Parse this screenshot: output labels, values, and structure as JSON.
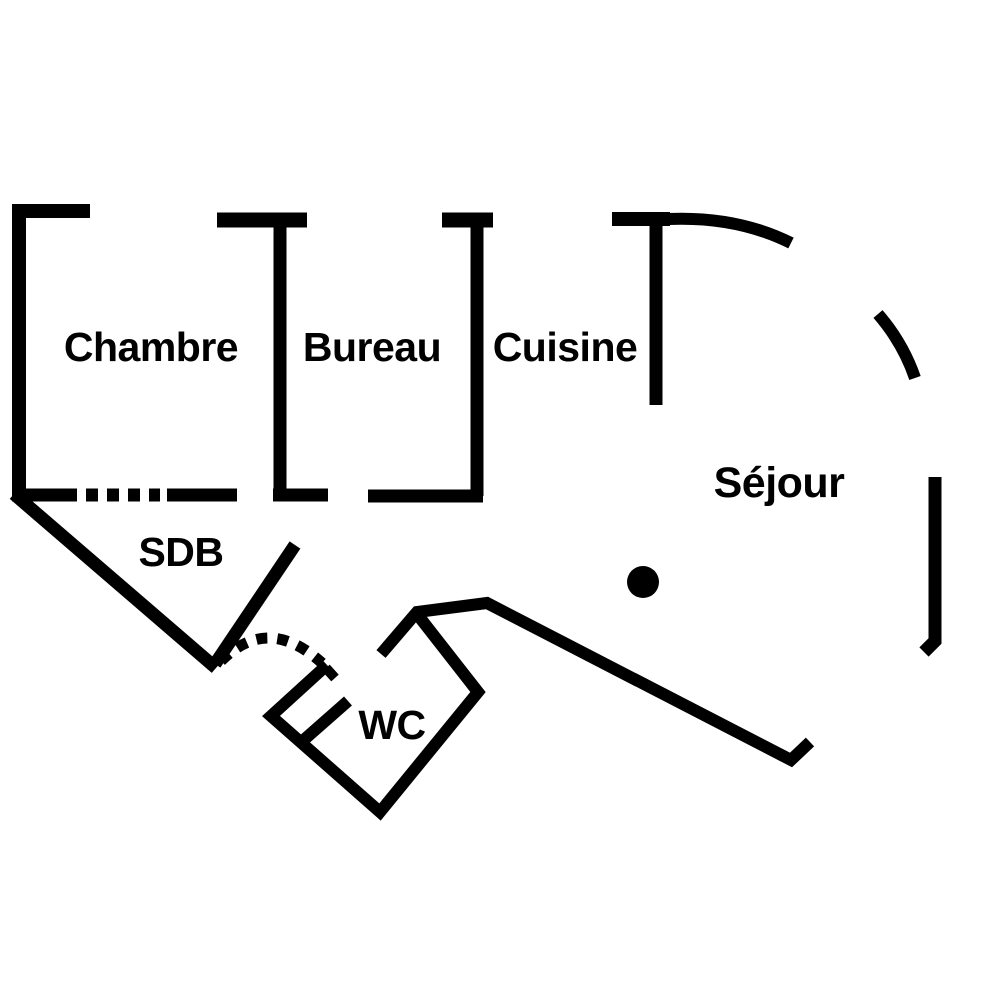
{
  "title": "Apartment floor plan",
  "colors": {
    "background": "#ffffff",
    "ink": "#000000"
  },
  "rooms": [
    {
      "id": "chambre",
      "label": "Chambre"
    },
    {
      "id": "bureau",
      "label": "Bureau"
    },
    {
      "id": "cuisine",
      "label": "Cuisine"
    },
    {
      "id": "sejour",
      "label": "Séjour"
    },
    {
      "id": "sdb",
      "label": "SDB"
    },
    {
      "id": "wc",
      "label": "WC"
    }
  ],
  "geometry": {
    "solid_walls": [
      {
        "name": "chambre-left-and-top-wall",
        "d": "M 90 211 L 19 211 L 19 498",
        "w": 14
      },
      {
        "name": "chambre-bottom-wall-left",
        "d": "M 12 495 L 77 495",
        "w": 13
      },
      {
        "name": "chambre-bottom-wall-right",
        "d": "M 167 495 L 237 495",
        "w": 13
      },
      {
        "name": "sdb-diagonal-wall",
        "d": "M 14 494 L 216 668",
        "w": 13
      },
      {
        "name": "bureau-divider-top-cap",
        "d": "M 217 220 L 307 220",
        "w": 15
      },
      {
        "name": "bureau-divider-stem",
        "d": "M 280 222 L 280 495",
        "w": 13
      },
      {
        "name": "bureau-divider-bottom-foot",
        "d": "M 273 495 L 328 495",
        "w": 13
      },
      {
        "name": "cuisine-divider-top-cap",
        "d": "M 442 220 L 493 220",
        "w": 15
      },
      {
        "name": "cuisine-divider-stem",
        "d": "M 477 222 L 477 496",
        "w": 13
      },
      {
        "name": "cuisine-divider-bottom-foot",
        "d": "M 368 496 L 483 496",
        "w": 13
      },
      {
        "name": "sejour-divider-top-cap",
        "d": "M 612 219 L 670 219",
        "w": 14
      },
      {
        "name": "sejour-divider-stem",
        "d": "M 656 221 L 656 405",
        "w": 13
      },
      {
        "name": "sejour-curved-wall-upper",
        "d": "M 668 219 Q 737 216 791 243",
        "w": 12
      },
      {
        "name": "sejour-curved-wall-middle",
        "d": "M 878 314 Q 903 343 915 378",
        "w": 12
      },
      {
        "name": "sejour-right-wall",
        "d": "M 935 477 L 935 641 L 924 652",
        "w": 13
      },
      {
        "name": "sejour-south-wall",
        "d": "M 381 654 L 417 612 L 487 603 L 791 760 L 810 742",
        "w": 12
      },
      {
        "name": "wc-walls",
        "d": "M 417 614 L 478 692 L 380 812 L 271 716 L 327 665",
        "w": 12
      },
      {
        "name": "wc-door-jamb-tick",
        "d": "M 326 668 L 335 678",
        "w": 10
      },
      {
        "name": "wc-door-leaf",
        "d": "M 348 701 L 298 745",
        "w": 12
      },
      {
        "name": "corridor-diagonal-wall",
        "d": "M 295 545 L 215 664",
        "w": 13
      }
    ],
    "dashed_walls": [
      {
        "name": "chambre-bottom-wall-dashed-opening",
        "d": "M 86 495 L 160 495",
        "w": 13,
        "dash": "12 9"
      },
      {
        "name": "door-swing-arc",
        "d": "M 221 661 Q 268 614 322 663",
        "w": 11,
        "dash": "11 10"
      }
    ],
    "furniture_dot": {
      "cx": 643,
      "cy": 582,
      "r": 16
    }
  }
}
